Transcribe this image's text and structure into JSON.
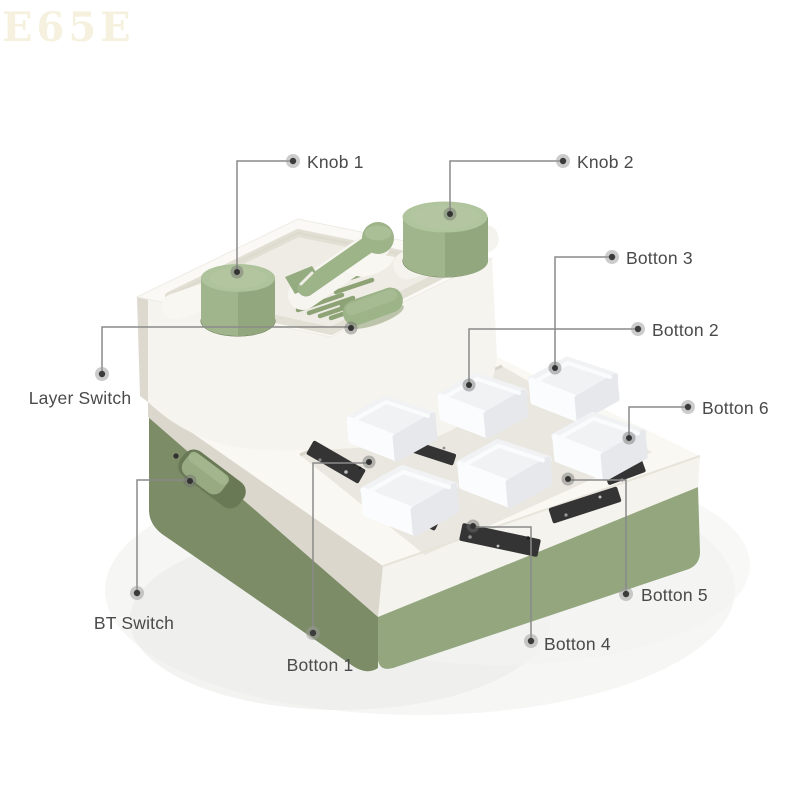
{
  "watermark": "E65E",
  "callouts": {
    "knob1": "Knob 1",
    "knob2": "Knob 2",
    "botton1": "Botton 1",
    "botton2": "Botton 2",
    "botton3": "Botton 3",
    "botton4": "Botton 4",
    "botton5": "Botton 5",
    "botton6": "Botton 6",
    "layer_switch": "Layer Switch",
    "bt_switch": "BT Switch"
  },
  "colors": {
    "knob_green": "#a8bc93",
    "tray_green_parts": "#9db388",
    "base_green_front": "#93a67e",
    "base_green_side": "#7b8c67",
    "body_white": "#f8f7f2",
    "body_side_shade": "#dbd7cc",
    "keycap_white": "#f4f5f7",
    "pcb_dark": "#343434",
    "leader_line": "#8a8a8a",
    "label_text": "#4a4a4a",
    "watermark_text": "#f5f1de"
  }
}
